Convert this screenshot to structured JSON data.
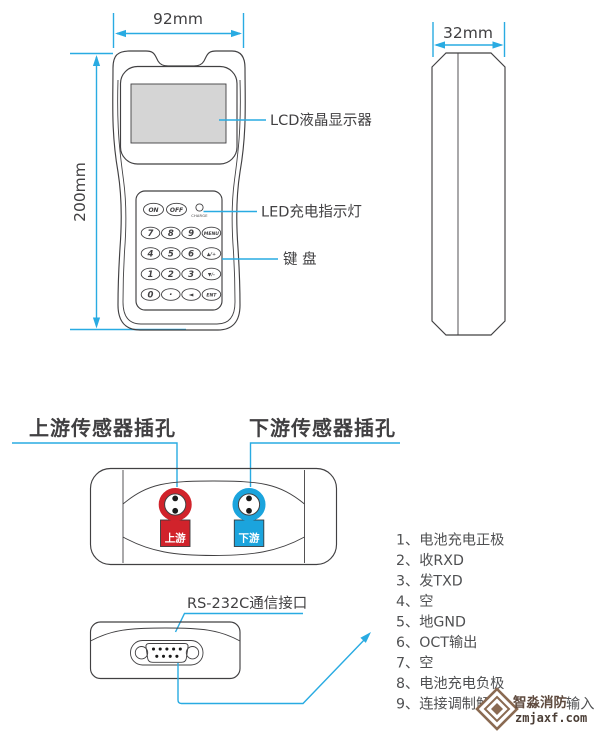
{
  "colors": {
    "accent": "#29abe2",
    "outline": "#414042",
    "red": "#d1232b",
    "blue": "#1ba4dd",
    "lcd_fill": "#d5d5d5",
    "pin_text": "#4f5052",
    "watermark_brown": "#8a6a52"
  },
  "front_view": {
    "width_dim": "92mm",
    "height_dim": "200mm",
    "power_keys": [
      "ON",
      "OFF"
    ],
    "charge_label": "CHARGE",
    "keypad_rows": [
      [
        "7",
        "8",
        "9",
        "MENU"
      ],
      [
        "4",
        "5",
        "6",
        "▲/+"
      ],
      [
        "1",
        "2",
        "3",
        "▼/-"
      ],
      [
        "0",
        "·",
        "◄",
        "ENT"
      ]
    ],
    "callouts": {
      "lcd": "LCD液晶显示器",
      "led": "LED充电指示灯",
      "keyboard": "键 盘"
    }
  },
  "side_view": {
    "width_dim": "32mm"
  },
  "top_view": {
    "upstream_callout": "上游传感器插孔",
    "downstream_callout": "下游传感器插孔",
    "upstream_tag": "上游",
    "downstream_tag": "下游"
  },
  "bottom_view": {
    "rs232_callout": "RS-232C通信接口"
  },
  "pinout": {
    "items": [
      "1、电池充电正极",
      "2、收RXD",
      "3、发TXD",
      "4、空",
      "5、地GND",
      "6、OCT输出",
      "7、空",
      "8、电池充电负极"
    ],
    "pin9_head": "9、连接调制解",
    "pin9_tail": "输入"
  },
  "watermark": {
    "brand": "智淼消防",
    "site": "zmjaxf.com"
  }
}
